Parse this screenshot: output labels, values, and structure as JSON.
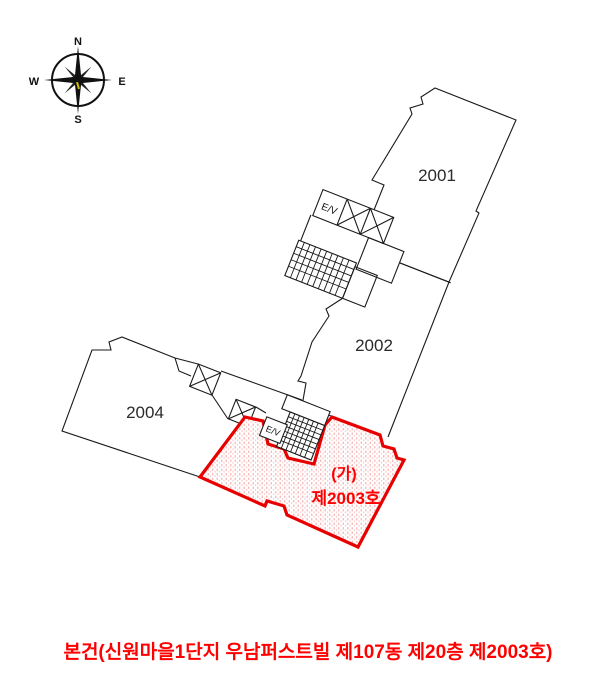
{
  "compass": {
    "north": "N",
    "east": "E",
    "south": "S",
    "west": "W"
  },
  "floorplan": {
    "unit_2001": "2001",
    "unit_2002": "2002",
    "unit_2004": "2004",
    "subject_mark": "(가)",
    "subject_unit": "제2003호",
    "elevator_core_label": "E/V",
    "subject_elevator_label": "E/V"
  },
  "caption": "본건(신원마을1단지 우남퍼스트빌 제107동 제20층 제2003호)",
  "colors": {
    "highlight_red": "#e80000",
    "label_red": "#ff0000",
    "hatch_pink": "#f5b6b6",
    "line_black": "#1a1a1a"
  }
}
